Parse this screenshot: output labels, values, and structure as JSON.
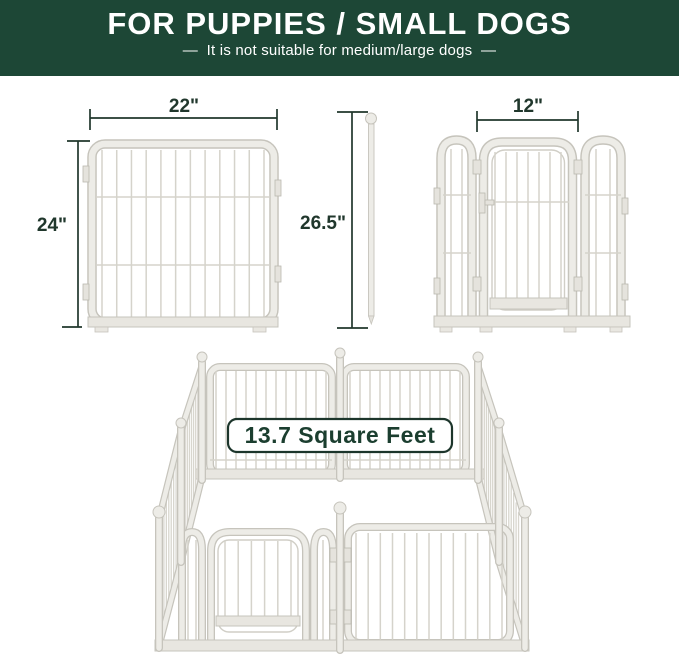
{
  "header": {
    "title": "FOR PUPPIES / SMALL DOGS",
    "subtitle": "—  It is not suitable for medium/large dogs  —"
  },
  "figures": {
    "single_panel": {
      "width_label": "22\"",
      "height_label": "24\""
    },
    "support_rod": {
      "height_label": "26.5\""
    },
    "door_panel": {
      "width_label": "12\""
    }
  },
  "pen": {
    "area_badge_label": "13.7 Square Feet"
  },
  "colors": {
    "header_bg": "#1d4736",
    "text_on_header": "#ffffff",
    "dimension_ink": "#20372c",
    "badge_border": "#1c352b",
    "badge_text": "#1b3e2f",
    "panel_fill": "#edece7",
    "panel_outline": "#c6c4bc",
    "bar": "#d5d3cb"
  }
}
